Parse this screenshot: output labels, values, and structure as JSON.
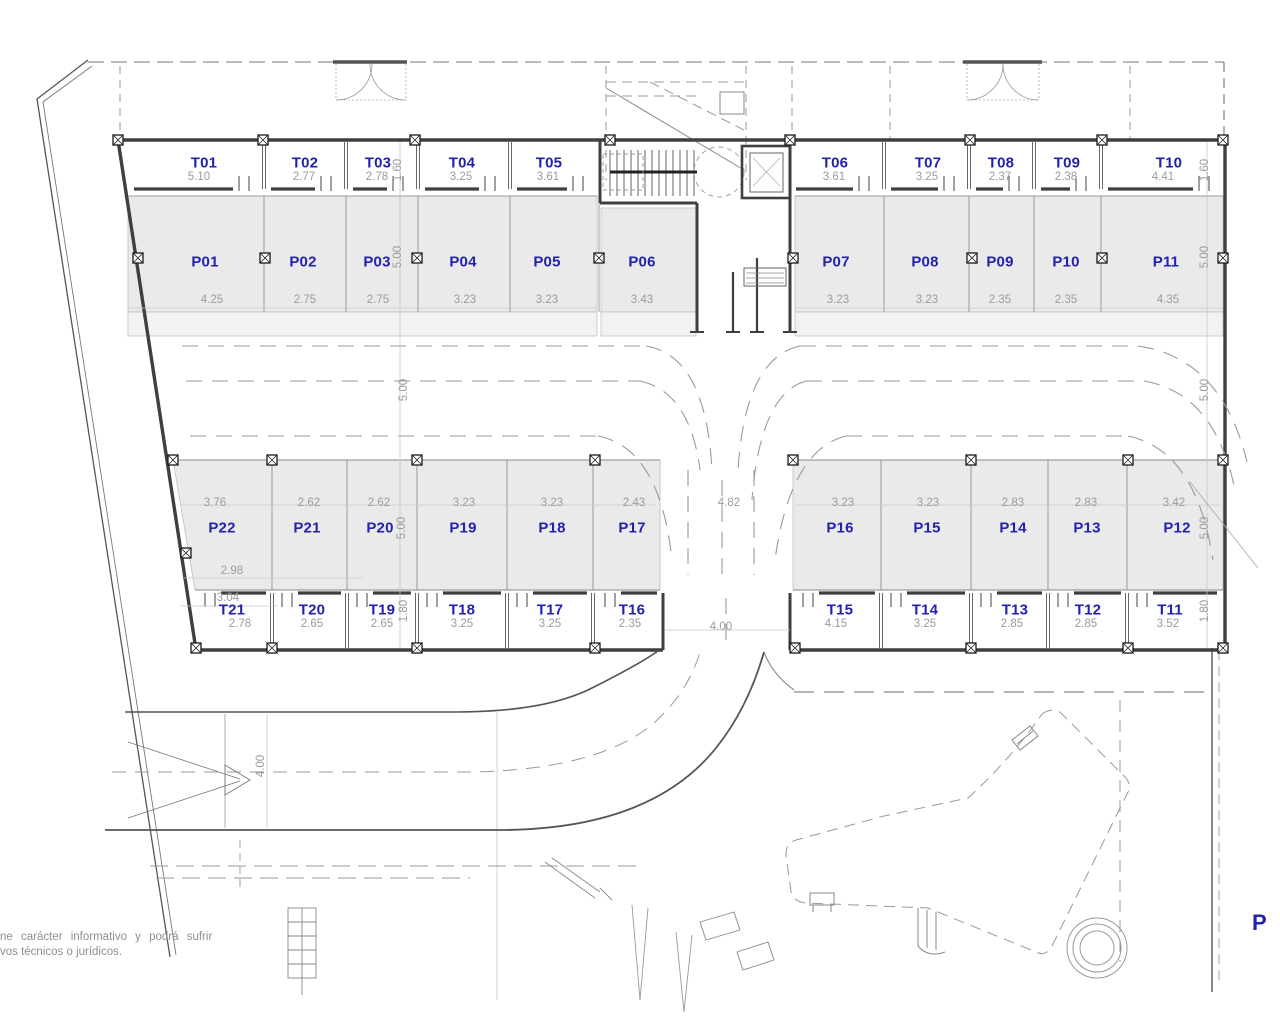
{
  "p_spaces": {
    "p01": {
      "label": "P01",
      "dim": "4.25"
    },
    "p02": {
      "label": "P02",
      "dim": "2.75"
    },
    "p03": {
      "label": "P03",
      "dim": "2.75"
    },
    "p04": {
      "label": "P04",
      "dim": "3.23"
    },
    "p05": {
      "label": "P05",
      "dim": "3.23"
    },
    "p06": {
      "label": "P06",
      "dim": "3.43"
    },
    "p07": {
      "label": "P07",
      "dim": "3.23"
    },
    "p08": {
      "label": "P08",
      "dim": "3.23"
    },
    "p09": {
      "label": "P09",
      "dim": "2.35"
    },
    "p10": {
      "label": "P10",
      "dim": "2.35"
    },
    "p11": {
      "label": "P11",
      "dim": "4.35"
    },
    "p12": {
      "label": "P12",
      "dim": "3.42"
    },
    "p13": {
      "label": "P13",
      "dim": "2.83"
    },
    "p14": {
      "label": "P14",
      "dim": "2.83"
    },
    "p15": {
      "label": "P15",
      "dim": "3.23"
    },
    "p16": {
      "label": "P16",
      "dim": "3.23"
    },
    "p17": {
      "label": "P17",
      "dim": "2.43"
    },
    "p18": {
      "label": "P18",
      "dim": "3.23"
    },
    "p19": {
      "label": "P19",
      "dim": "3.23"
    },
    "p20": {
      "label": "P20",
      "dim": "2.62"
    },
    "p21": {
      "label": "P21",
      "dim": "2.62"
    },
    "p22": {
      "label": "P22",
      "dim": "3.76"
    }
  },
  "t_rooms": {
    "t01": {
      "label": "T01",
      "dim": "5.10"
    },
    "t02": {
      "label": "T02",
      "dim": "2.77"
    },
    "t03": {
      "label": "T03",
      "dim": "2.78"
    },
    "t04": {
      "label": "T04",
      "dim": "3.25"
    },
    "t05": {
      "label": "T05",
      "dim": "3.61"
    },
    "t06": {
      "label": "T06",
      "dim": "3.61"
    },
    "t07": {
      "label": "T07",
      "dim": "3.25"
    },
    "t08": {
      "label": "T08",
      "dim": "2.37"
    },
    "t09": {
      "label": "T09",
      "dim": "2.38"
    },
    "t10": {
      "label": "T10",
      "dim": "4.41"
    },
    "t11": {
      "label": "T11",
      "dim": "3.52"
    },
    "t12": {
      "label": "T12",
      "dim": "2.85"
    },
    "t13": {
      "label": "T13",
      "dim": "2.85"
    },
    "t14": {
      "label": "T14",
      "dim": "3.25"
    },
    "t15": {
      "label": "T15",
      "dim": "4.15"
    },
    "t16": {
      "label": "T16",
      "dim": "2.35"
    },
    "t17": {
      "label": "T17",
      "dim": "3.25"
    },
    "t18": {
      "label": "T18",
      "dim": "3.25"
    },
    "t19": {
      "label": "T19",
      "dim": "2.65"
    },
    "t20": {
      "label": "T20",
      "dim": "2.65"
    },
    "t21": {
      "label": "T21",
      "dim": "2.78"
    }
  },
  "v_dims": {
    "t_top_left": "1.60",
    "p_top_left": "5.00",
    "t_top_right": "1.60",
    "p_top_right": "5.00",
    "aisle_left": "5.00",
    "aisle_right": "5.00",
    "p_bottom_left": "5.00",
    "p_bottom_right": "5.00",
    "t_bottom_left": "1.80",
    "t_bottom_right": "1.80",
    "ramp": "4.00"
  },
  "extra_dims": {
    "lane_top": "4.82",
    "lane_bottom": "4.00",
    "p22_front": "2.98",
    "p22_door": "3.04"
  },
  "footer": {
    "line1": "ne carácter informativo y podrá sufrir",
    "line2": "vos técnicos o jurídicos."
  },
  "corner_label": "P",
  "colors": {
    "label_blue": "#2222ac",
    "dim_gray": "#9b9b9b",
    "bay_fill": "#eaeaea"
  }
}
